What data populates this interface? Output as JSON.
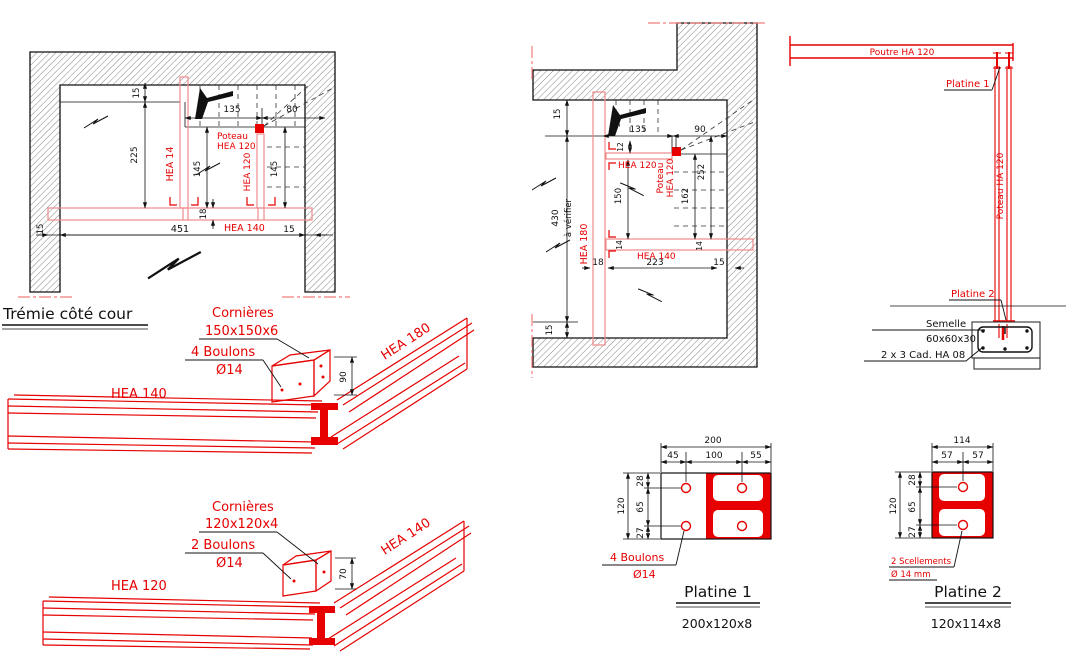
{
  "title": "Trémie côté cour",
  "colors": {
    "red": "#e60000",
    "pink": "#f08a8a",
    "centerline": "#f47c7c",
    "black": "#111111"
  },
  "left_plan": {
    "d15_top": "15",
    "d225": "225",
    "d80_rot": "80",
    "d135": "135",
    "d80": "80",
    "d145_l": "145",
    "d145_r": "145",
    "d18": "18",
    "d15_bl": "15",
    "d451": "451",
    "d15_br": "15",
    "hea14": "HEA 14",
    "hea120": "HEA 120",
    "hea140": "HEA 140",
    "poteau1": "Poteau",
    "poteau2": "HEA 120"
  },
  "middle_plan": {
    "d15_top": "15",
    "d90_rot": "90",
    "d135": "135",
    "d90": "90",
    "d12": "12",
    "d150": "150",
    "d162": "162",
    "d252": "252",
    "d430": "430",
    "averifier": "à vérifier",
    "d15_bot": "15",
    "d18": "18",
    "d223": "223",
    "d15_r": "15",
    "d14_l": "14",
    "d14_r": "14",
    "hea180": "HEA 180",
    "hea120": "HEA 120",
    "hea140": "HEA 140",
    "poteau1": "Poteau",
    "poteau2": "HEA 120"
  },
  "elevation": {
    "poutre": "Poutre HA 120",
    "platine1": "Platine 1",
    "poteau": "Poteau HA 120",
    "platine2": "Platine 2",
    "semelle_l1": "Semelle",
    "semelle_l2": "60x60x30",
    "cadres": "2 x 3 Cad. HA 08"
  },
  "iso1": {
    "cornieres": "Cornières",
    "size": "150x150x6",
    "boulons": "4 Boulons",
    "dia": "Ø14",
    "d90": "90",
    "hea180": "HEA 180",
    "hea140": "HEA 140"
  },
  "iso2": {
    "cornieres": "Cornières",
    "size": "120x120x4",
    "boulons": "2 Boulons",
    "dia": "Ø14",
    "d70": "70",
    "hea140": "HEA 140",
    "hea120": "HEA 120"
  },
  "platine1": {
    "d200": "200",
    "d45": "45",
    "d100": "100",
    "d55": "55",
    "d120": "120",
    "d28": "28",
    "d65": "65",
    "d27": "27",
    "boulons": "4 Boulons",
    "dia": "Ø14",
    "title": "Platine 1",
    "size": "200x120x8"
  },
  "platine2": {
    "d114": "114",
    "d57l": "57",
    "d57r": "57",
    "d120": "120",
    "d28": "28",
    "d65": "65",
    "d27": "27",
    "scellements": "2 Scellements",
    "dia": "Ø 14 mm",
    "title": "Platine 2",
    "size": "120x114x8"
  }
}
